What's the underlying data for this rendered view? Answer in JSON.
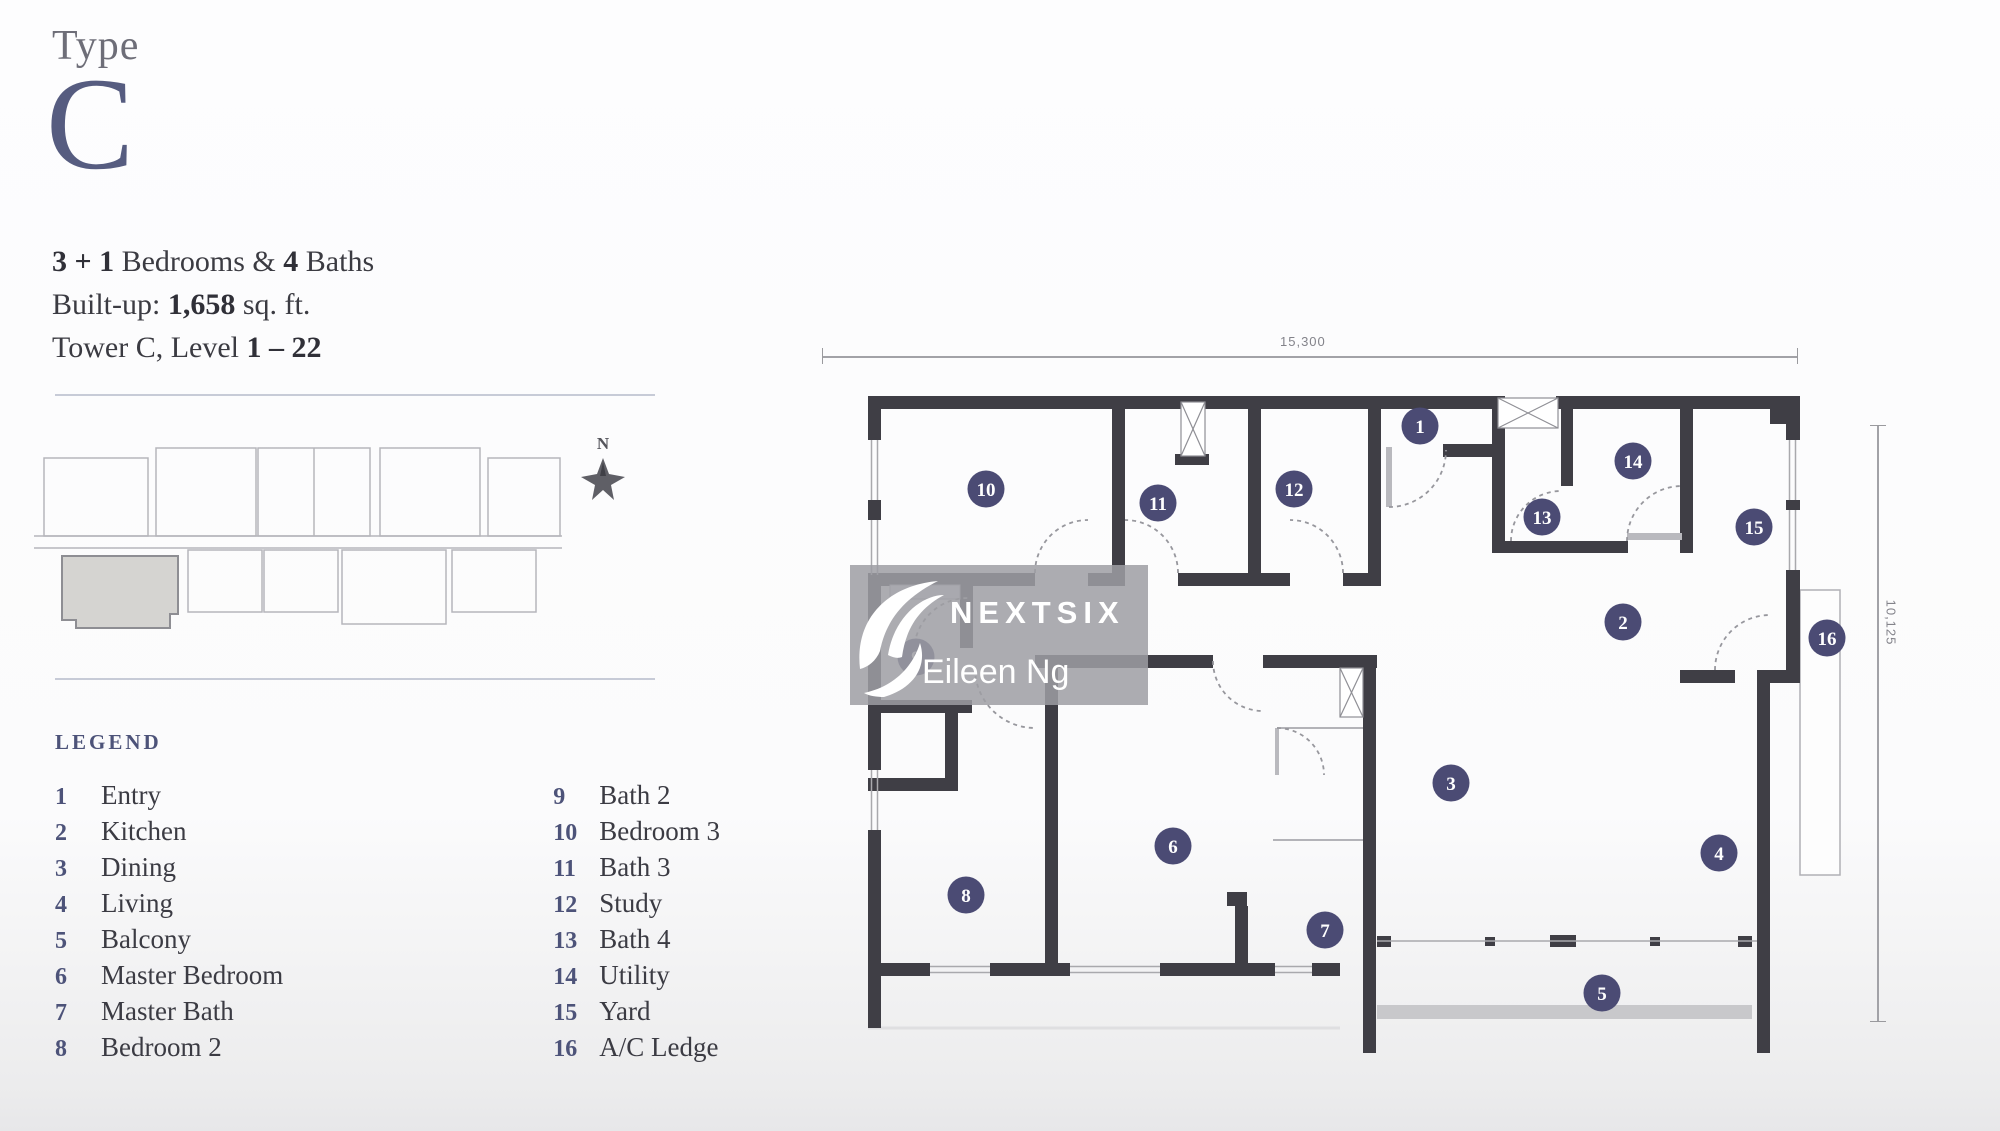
{
  "header": {
    "type_label": "Type",
    "type_letter": "C"
  },
  "info": {
    "beds_bold": "3 + 1",
    "beds_mid": " Bedrooms & ",
    "baths_bold": "4",
    "baths_end": " Baths",
    "built_label": "Built-up: ",
    "built_value": "1,658",
    "built_unit": " sq. ft.",
    "tower_label": "Tower C, Level ",
    "tower_value": "1 – 22"
  },
  "keyplan": {
    "north_label": "N"
  },
  "legend": {
    "title": "LEGEND",
    "col1": [
      {
        "n": "1",
        "label": "Entry"
      },
      {
        "n": "2",
        "label": "Kitchen"
      },
      {
        "n": "3",
        "label": "Dining"
      },
      {
        "n": "4",
        "label": "Living"
      },
      {
        "n": "5",
        "label": "Balcony"
      },
      {
        "n": "6",
        "label": "Master Bedroom"
      },
      {
        "n": "7",
        "label": "Master Bath"
      },
      {
        "n": "8",
        "label": "Bedroom 2"
      }
    ],
    "col2": [
      {
        "n": "9",
        "label": "Bath 2"
      },
      {
        "n": "10",
        "label": "Bedroom 3"
      },
      {
        "n": "11",
        "label": "Bath 3"
      },
      {
        "n": "12",
        "label": "Study"
      },
      {
        "n": "13",
        "label": "Bath 4"
      },
      {
        "n": "14",
        "label": "Utility"
      },
      {
        "n": "15",
        "label": "Yard"
      },
      {
        "n": "16",
        "label": "A/C Ledge"
      }
    ]
  },
  "floorplan": {
    "dim_width": "15,300",
    "dim_depth": "10,125",
    "markers": [
      {
        "n": "1",
        "x": 570,
        "y": 56
      },
      {
        "n": "2",
        "x": 773,
        "y": 252
      },
      {
        "n": "3",
        "x": 601,
        "y": 413
      },
      {
        "n": "4",
        "x": 869,
        "y": 483
      },
      {
        "n": "5",
        "x": 752,
        "y": 623
      },
      {
        "n": "6",
        "x": 323,
        "y": 476
      },
      {
        "n": "7",
        "x": 475,
        "y": 560
      },
      {
        "n": "8",
        "x": 116,
        "y": 525
      },
      {
        "n": "9",
        "x": 66,
        "y": 287
      },
      {
        "n": "10",
        "x": 136,
        "y": 119
      },
      {
        "n": "11",
        "x": 308,
        "y": 133
      },
      {
        "n": "12",
        "x": 444,
        "y": 119
      },
      {
        "n": "13",
        "x": 692,
        "y": 147
      },
      {
        "n": "14",
        "x": 783,
        "y": 91
      },
      {
        "n": "15",
        "x": 904,
        "y": 157
      },
      {
        "n": "16",
        "x": 977,
        "y": 268
      }
    ]
  },
  "watermark": {
    "brand": "NEXTSIX",
    "agent": "Eileen Ng"
  },
  "colors": {
    "wall": "#3f3e45",
    "marker": "#4b4b74",
    "accent_navy": "#565c80",
    "legend_number": "#4d5379",
    "dimension": "#83838a",
    "keyplan_line": "#b6b6bb",
    "keyplan_highlight": "#d5d4d1"
  }
}
